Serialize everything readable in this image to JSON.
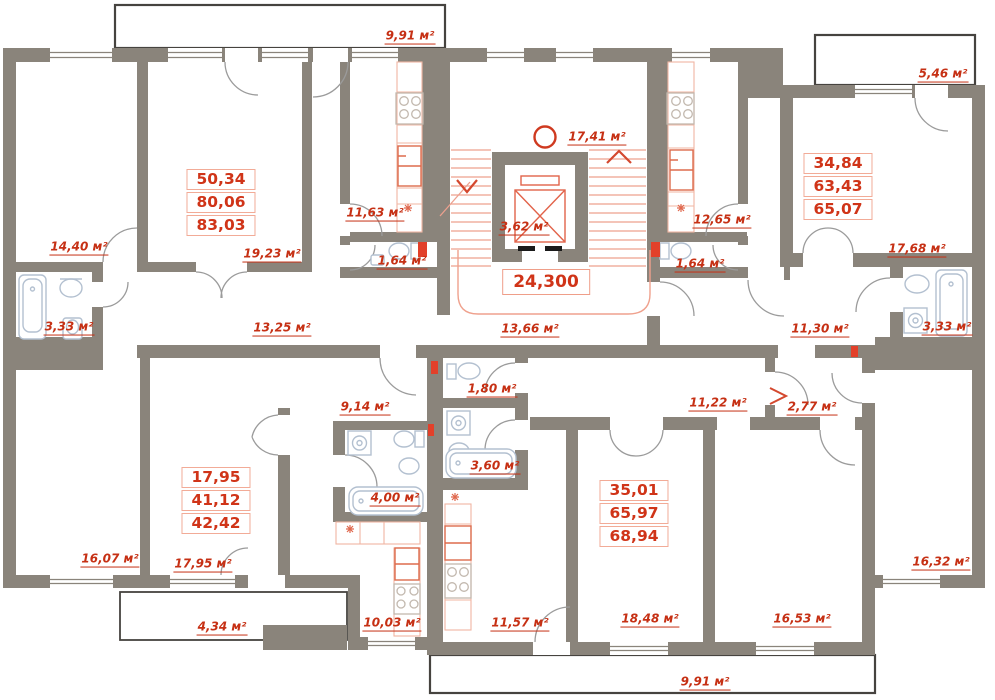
{
  "floor_plan": {
    "unit": "м²",
    "colors": {
      "wall": "#8a847b",
      "label_red": "#c63014",
      "value_red": "#d03418",
      "box_border": "#f2ab97",
      "stairs_red": "#eda08e",
      "fixture_blue": "#b3c0d0",
      "appliance_red": "#dd6b4d",
      "vent_red": "#e2402a"
    },
    "area_labels": [
      {
        "id": "balcony-top",
        "text": "9,91 м²",
        "x": 410,
        "y": 38
      },
      {
        "id": "room-14-40",
        "text": "14,40 м²",
        "x": 79,
        "y": 249
      },
      {
        "id": "room-19-23",
        "text": "19,23 м²",
        "x": 272,
        "y": 256
      },
      {
        "id": "kitchen-11-63",
        "text": "11,63 м²",
        "x": 375,
        "y": 215
      },
      {
        "id": "wc-1-64-left",
        "text": "1,64 м²",
        "x": 402,
        "y": 263
      },
      {
        "id": "bath-3-33-left",
        "text": "3,33 м²",
        "x": 69,
        "y": 329
      },
      {
        "id": "corridor-13-25",
        "text": "13,25 м²",
        "x": 282,
        "y": 330
      },
      {
        "id": "stair-hall-17-41",
        "text": "17,41 м²",
        "x": 597,
        "y": 139
      },
      {
        "id": "elevator-3-62",
        "text": "3,62 м²",
        "x": 524,
        "y": 229
      },
      {
        "id": "corridor-13-66",
        "text": "13,66 м²",
        "x": 530,
        "y": 331
      },
      {
        "id": "kitchen-12-65",
        "text": "12,65 м²",
        "x": 722,
        "y": 222
      },
      {
        "id": "wc-1-64-right",
        "text": "1,64 м²",
        "x": 700,
        "y": 266
      },
      {
        "id": "balcony-5-46",
        "text": "5,46 м²",
        "x": 943,
        "y": 76
      },
      {
        "id": "room-17-68",
        "text": "17,68 м²",
        "x": 917,
        "y": 251
      },
      {
        "id": "bath-3-33-right",
        "text": "3,33 м²",
        "x": 947,
        "y": 329
      },
      {
        "id": "corridor-11-30",
        "text": "11,30 м²",
        "x": 820,
        "y": 331
      },
      {
        "id": "room-16-07",
        "text": "16,07 м²",
        "x": 110,
        "y": 561
      },
      {
        "id": "room-17-95",
        "text": "17,95 м²",
        "x": 203,
        "y": 566
      },
      {
        "id": "hall-9-14",
        "text": "9,14 м²",
        "x": 365,
        "y": 409
      },
      {
        "id": "wc-1-80",
        "text": "1,80 м²",
        "x": 492,
        "y": 391
      },
      {
        "id": "bath-3-60",
        "text": "3,60 м²",
        "x": 495,
        "y": 468
      },
      {
        "id": "bath-4-00",
        "text": "4,00 м²",
        "x": 395,
        "y": 500
      },
      {
        "id": "balcony-4-34",
        "text": "4,34 м²",
        "x": 222,
        "y": 629
      },
      {
        "id": "kitchen-10-03",
        "text": "10,03 м²",
        "x": 392,
        "y": 625
      },
      {
        "id": "kitchen-11-57",
        "text": "11,57 м²",
        "x": 520,
        "y": 625
      },
      {
        "id": "room-18-48",
        "text": "18,48 м²",
        "x": 650,
        "y": 621
      },
      {
        "id": "room-16-53",
        "text": "16,53 м²",
        "x": 802,
        "y": 621
      },
      {
        "id": "room-16-32",
        "text": "16,32 м²",
        "x": 941,
        "y": 564
      },
      {
        "id": "hall-2-77",
        "text": "2,77 м²",
        "x": 812,
        "y": 409
      },
      {
        "id": "corridor-11-22",
        "text": "11,22 м²",
        "x": 718,
        "y": 405
      },
      {
        "id": "balcony-bottom",
        "text": "9,91 м²",
        "x": 705,
        "y": 684
      }
    ],
    "apartment_boxes": [
      {
        "id": "apt-top-left",
        "values": [
          "50,34",
          "80,06",
          "83,03"
        ],
        "x": 221,
        "y": 169
      },
      {
        "id": "apt-top-right",
        "values": [
          "34,84",
          "63,43",
          "65,07"
        ],
        "x": 838,
        "y": 153
      },
      {
        "id": "apt-bottom-left",
        "values": [
          "17,95",
          "41,12",
          "42,42"
        ],
        "x": 216,
        "y": 467
      },
      {
        "id": "apt-bottom-right",
        "values": [
          "35,01",
          "65,97",
          "68,94"
        ],
        "x": 634,
        "y": 480
      }
    ],
    "floor_total": {
      "text": "24,300",
      "x": 546,
      "y": 269
    }
  }
}
